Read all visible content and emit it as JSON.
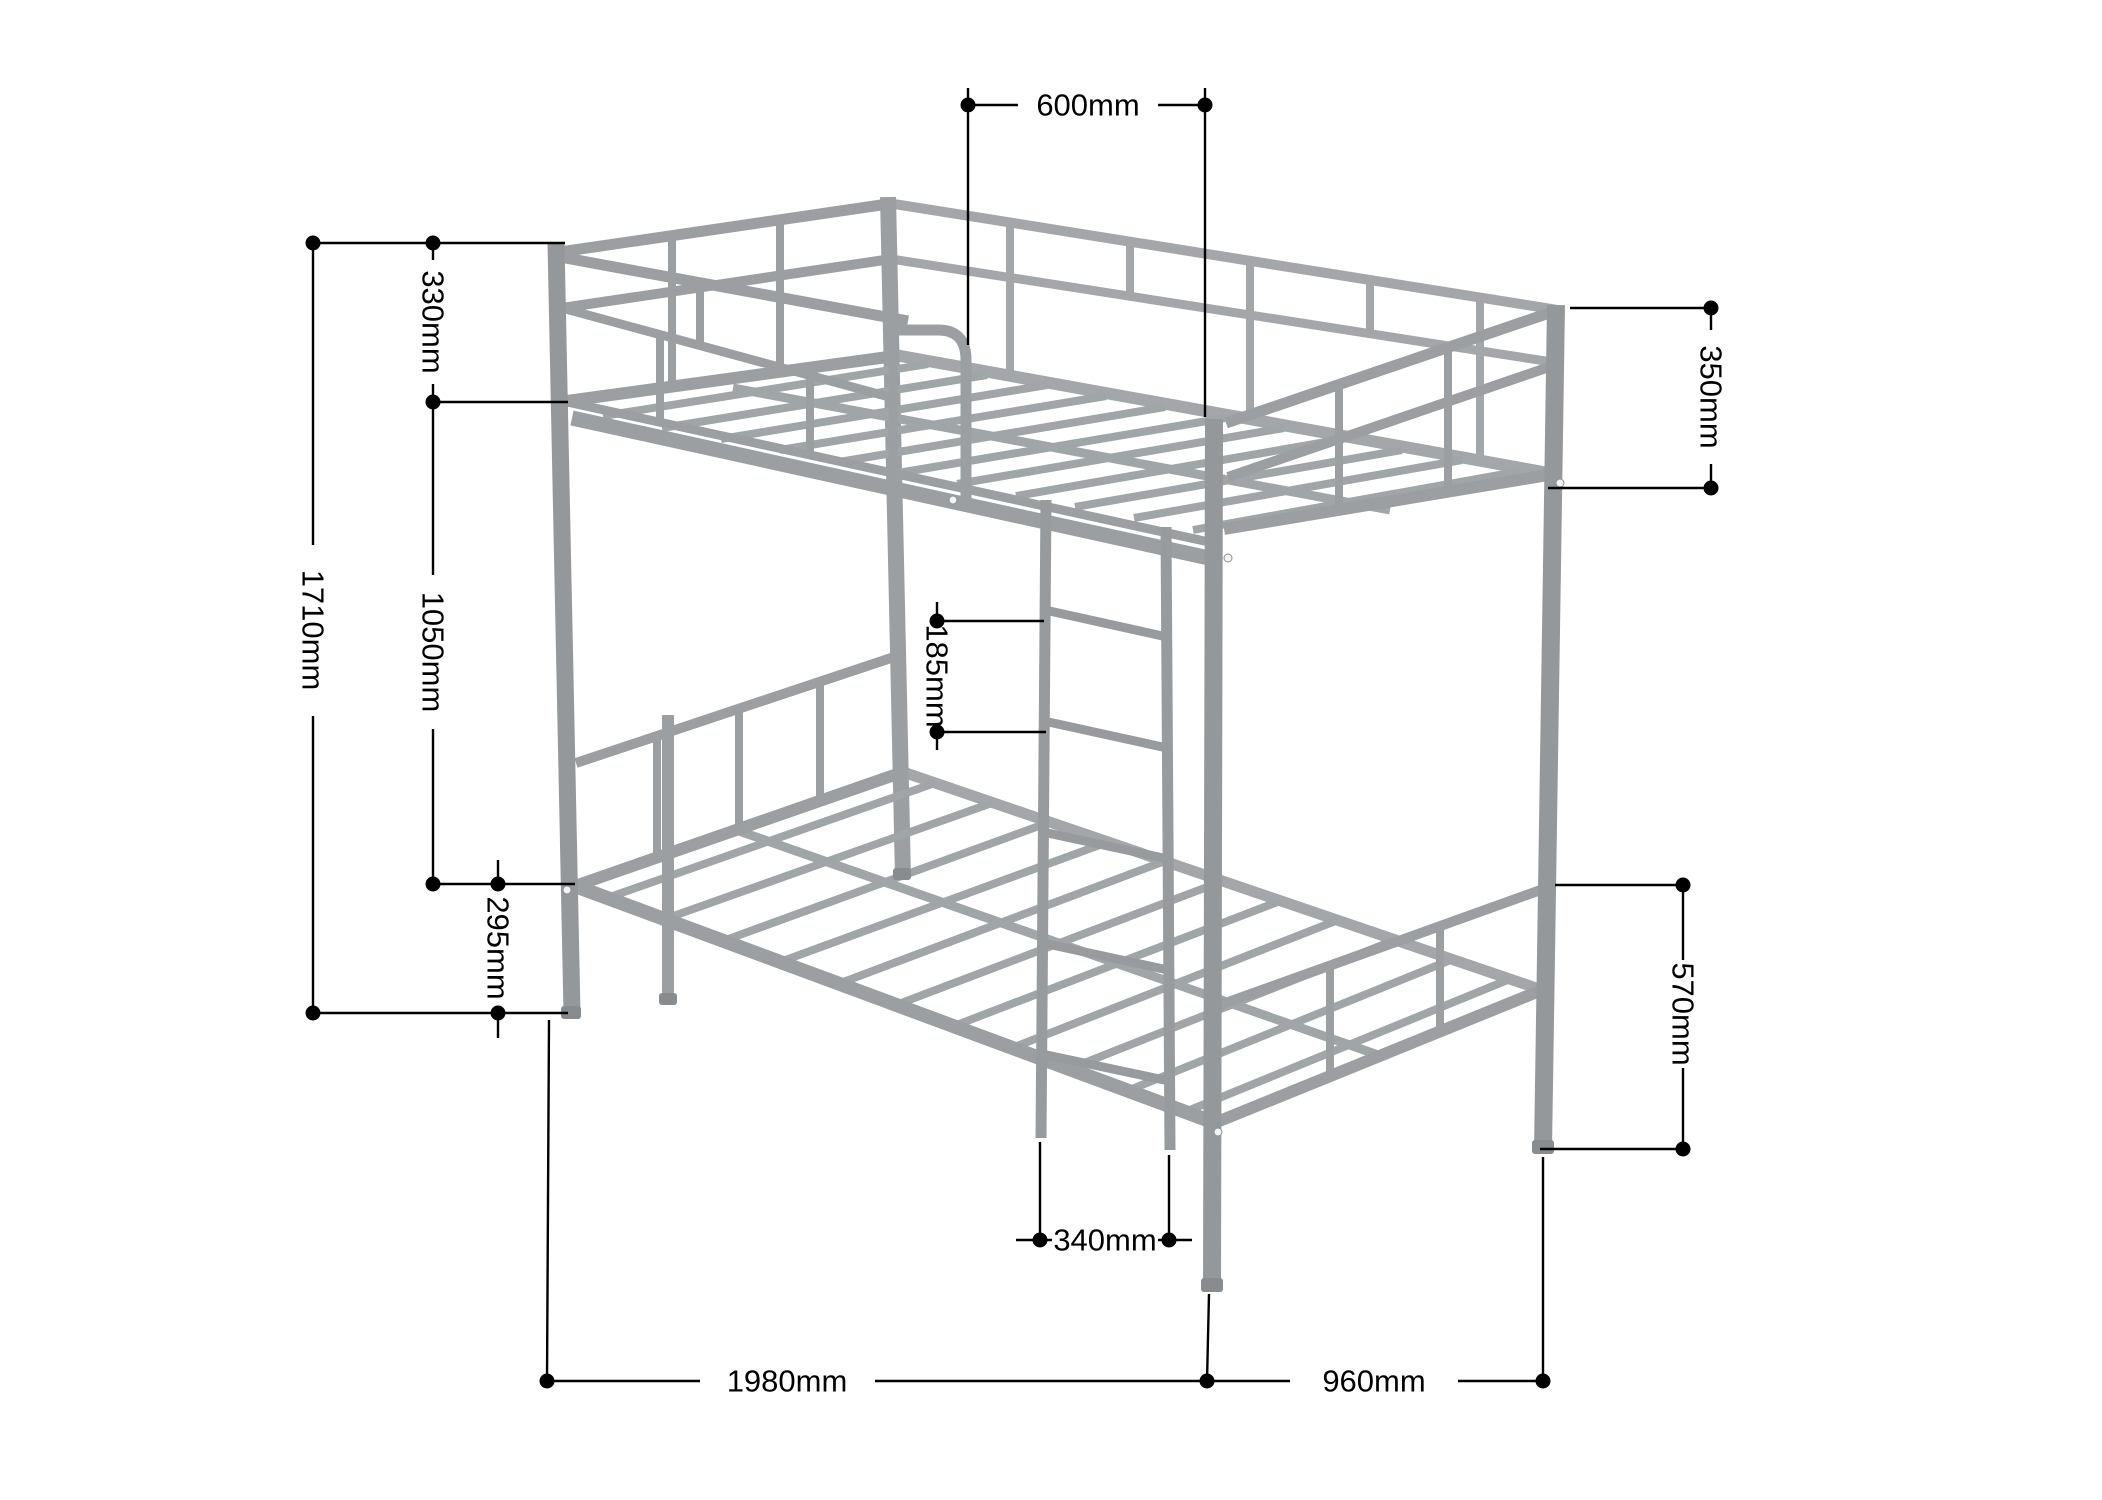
{
  "figure": {
    "type": "product-dimension-diagram",
    "subject": "metal bunk bed frame, isometric view with dimension callouts",
    "unit": "mm",
    "colors": {
      "frame": "#9b9fa2",
      "frame_dark": "#94989b",
      "annotation": "#000000",
      "background": "#ffffff"
    },
    "labels": {
      "ladder_opening_width": "600mm",
      "upper_guardrail_height": "330mm",
      "overall_height": "1710mm",
      "bunk_to_bunk_height": "1050mm",
      "lower_deck_floor_clearance": "295mm",
      "post_top_to_upper_deck": "350mm",
      "ladder_rung_spacing": "185mm",
      "footboard_to_floor": "570mm",
      "ladder_width": "340mm",
      "overall_length": "1980mm",
      "overall_width": "960mm"
    }
  }
}
